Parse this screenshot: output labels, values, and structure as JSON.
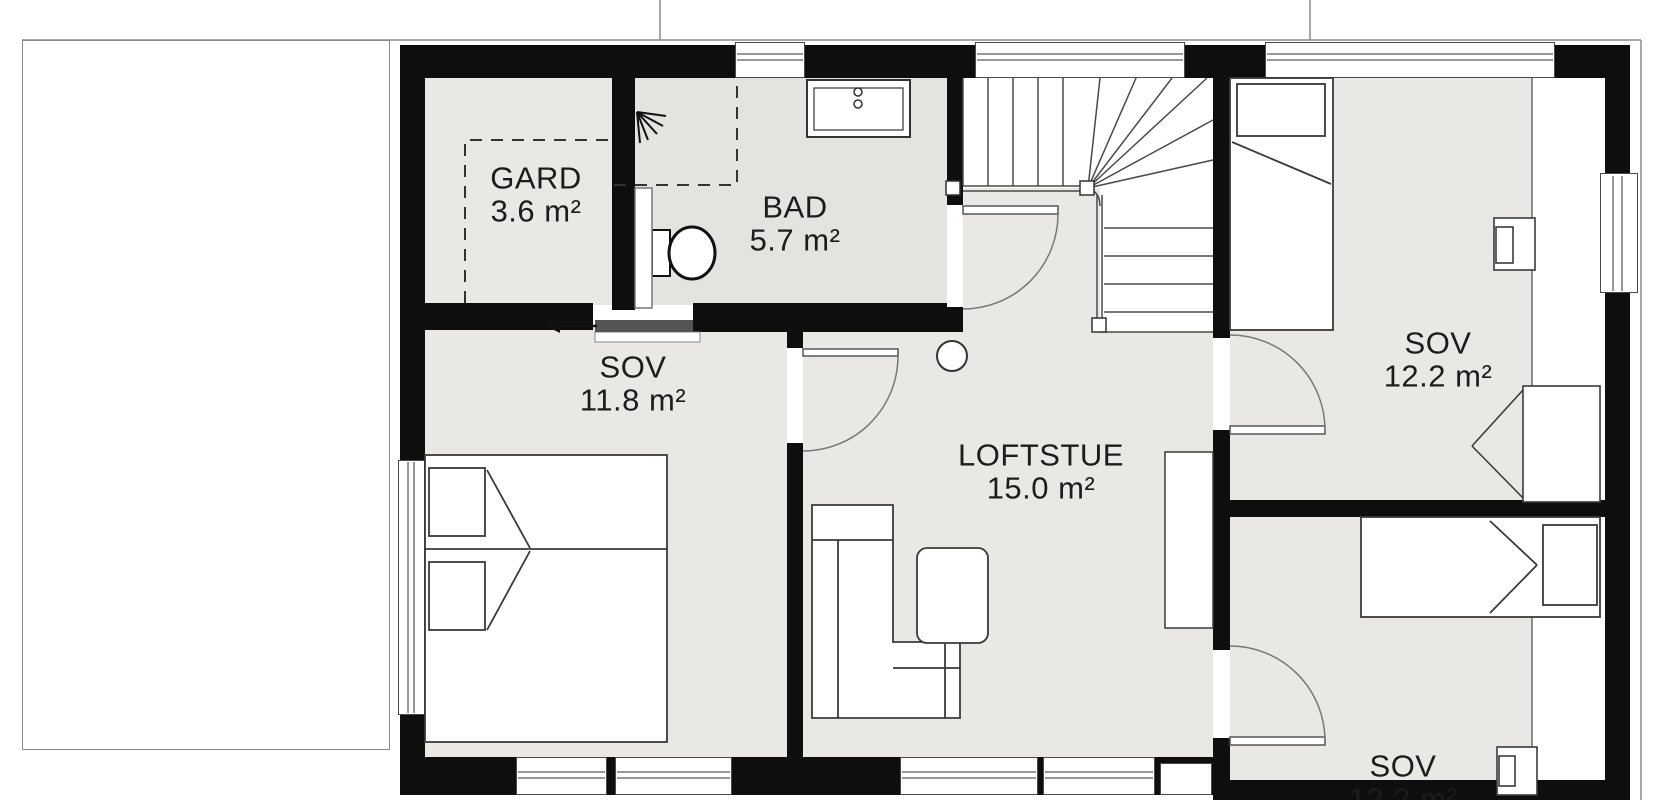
{
  "plan": {
    "rooms": [
      {
        "id": "gard",
        "name": "GARD",
        "area": "3.6 m²"
      },
      {
        "id": "bad",
        "name": "BAD",
        "area": "5.7 m²"
      },
      {
        "id": "sov-left",
        "name": "SOV",
        "area": "11.8 m²"
      },
      {
        "id": "loftstue",
        "name": "LOFTSTUE",
        "area": "15.0 m²"
      },
      {
        "id": "sov-upper-right",
        "name": "SOV",
        "area": "12.2 m²"
      },
      {
        "id": "sov-lower-right",
        "name": "SOV",
        "area": "12.2 m²"
      }
    ],
    "colors": {
      "wall": "#0e0e0e",
      "floor": "#e9e8e4",
      "floor_bath": "#e3e3e0",
      "line": "#4a4a4a",
      "background": "#ffffff"
    }
  }
}
